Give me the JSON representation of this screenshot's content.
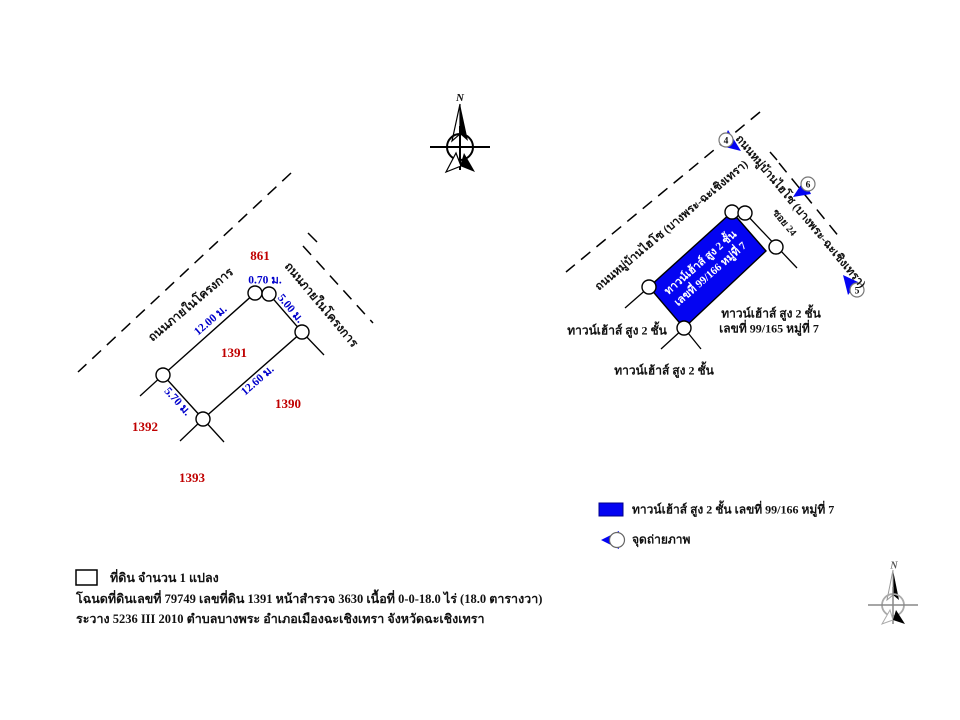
{
  "north": {
    "label": "N"
  },
  "colors": {
    "parcel_fill": "#0404f2",
    "dimension_text": "#0000cc",
    "neighbor_number_text": "#c00000",
    "line_color": "#000000"
  },
  "survey_sketch": {
    "road_left": "ถนนภายในโครงการ",
    "road_right": "ถนนภายในโครงการ",
    "parcel_number": "1391",
    "neighbor_top": "861",
    "neighbor_right": "1390",
    "neighbor_left": "1392",
    "neighbor_bottom": "1393",
    "dim_top": "0.70 ม.",
    "dim_upper_left": "12.00 ม.",
    "dim_upper_right": "5.00 ม.",
    "dim_lower_right": "12.60 ม.",
    "dim_lower_left": "5.70 ม."
  },
  "location_map": {
    "road_left": "ถนนหมู่บ้านไฮโซ (บางพระ-ฉะเชิงเทรา)",
    "road_right": "ถนนหมู่บ้านไฮโซ (บางพระ-ฉะเชิงเทรา)",
    "soi_label": "ซอย 24",
    "subject_line1": "ทาวน์เฮ้าส์ สูง 2 ชั้น",
    "subject_line2": "เลขที่ 99/166 หมู่ที่ 7",
    "neighbor_left": "ทาวน์เฮ้าส์ สูง 2 ชั้น",
    "neighbor_right_line1": "ทาวน์เฮ้าส์ สูง 2 ชั้น",
    "neighbor_right_line2": "เลขที่ 99/165 หมู่ที่ 7",
    "neighbor_bottom": "ทาวน์เฮ้าส์ สูง 2 ชั้น",
    "photo_points": [
      "4",
      "6",
      "5"
    ]
  },
  "legend": {
    "parcel_label": "ทาวน์เฮ้าส์ สูง 2 ชั้น เลขที่ 99/166 หมู่ที่ 7",
    "photo_label": "จุดถ่ายภาพ"
  },
  "land_info": {
    "line1": "ที่ดิน จำนวน 1 แปลง",
    "line2": "โฉนดที่ดินเลขที่ 79749 เลขที่ดิน 1391 หน้าสำรวจ 3630 เนื้อที่ 0-0-18.0 ไร่ (18.0 ตารางวา)",
    "line3": "ระวาง 5236 III 2010 ตำบลบางพระ อำเภอเมืองฉะเชิงเทรา จังหวัดฉะเชิงเทรา"
  }
}
